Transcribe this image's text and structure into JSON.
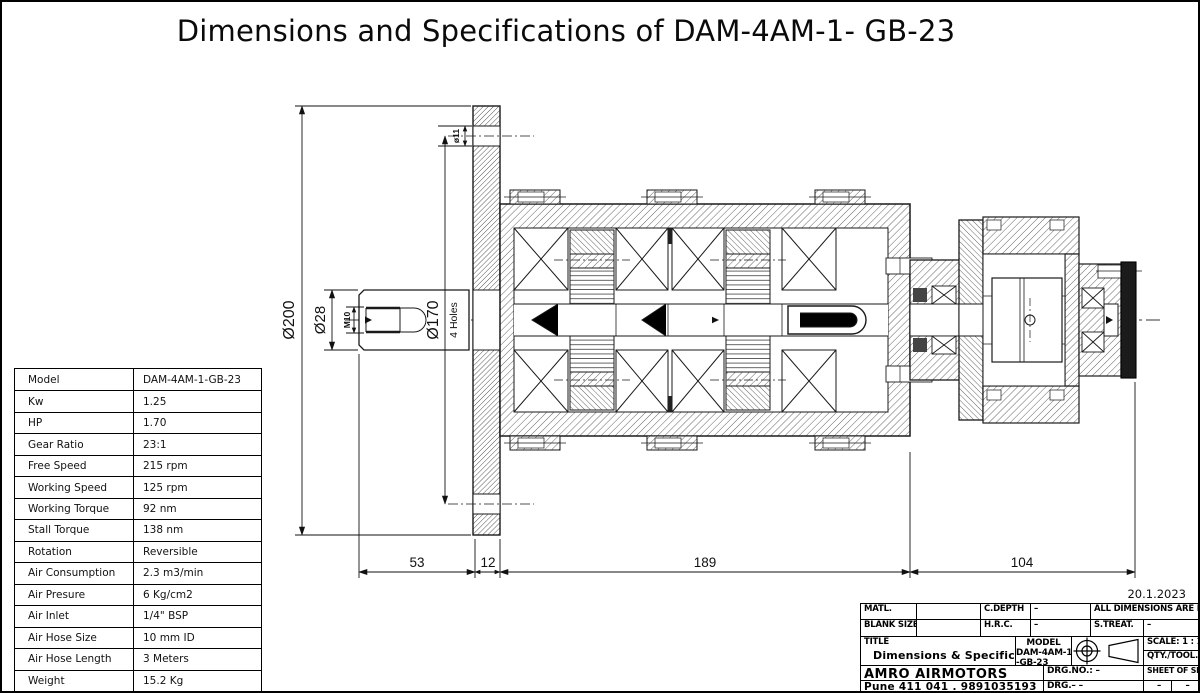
{
  "page": {
    "title": "Dimensions and Specifications of DAM-4AM-1- GB-23"
  },
  "spec_table": {
    "rows": [
      {
        "label": "Model",
        "value": "DAM-4AM-1-GB-23"
      },
      {
        "label": "Kw",
        "value": "1.25"
      },
      {
        "label": "HP",
        "value": "1.70"
      },
      {
        "label": "Gear Ratio",
        "value": "23:1"
      },
      {
        "label": "Free Speed",
        "value": "215 rpm"
      },
      {
        "label": "Working Speed",
        "value": "125 rpm"
      },
      {
        "label": "Working Torque",
        "value": "92 nm"
      },
      {
        "label": "Stall Torque",
        "value": "138 nm"
      },
      {
        "label": "Rotation",
        "value": "Reversible"
      },
      {
        "label": "Air Consumption",
        "value": "2.3 m3/min"
      },
      {
        "label": "Air Presure",
        "value": "6 Kg/cm2"
      },
      {
        "label": "Air Inlet",
        "value": "1/4\" BSP"
      },
      {
        "label": "Air Hose Size",
        "value": "10 mm ID"
      },
      {
        "label": "Air Hose Length",
        "value": "3 Meters"
      },
      {
        "label": "Weight",
        "value": "15.2 Kg"
      }
    ]
  },
  "drawing": {
    "dims": {
      "d200": "Ø200",
      "d28": "Ø28",
      "d170": "Ø170",
      "holes": "4 Holes",
      "m10": "M10",
      "d11": "ø11",
      "len_shaft": "53",
      "len_flange": "12",
      "len_gearbox": "189",
      "len_motor": "104"
    }
  },
  "title_block": {
    "date": "20.1.2023",
    "matl_label": "MATL.",
    "blank_size_label": "BLANK SIZE",
    "cdepth_label": "C.DEPTH",
    "cdepth_value": "–",
    "hrc_label": "H.R.C.",
    "hrc_value": "–",
    "all_dims_note": "ALL DIMENSIONS ARE IN MM.",
    "streat_label": "S.TREAT.",
    "streat_value": "–",
    "title_label": "TITLE",
    "title_value": "Dimensions & Specifications",
    "model_label": "MODEL",
    "model_value_line1": "DAM-4AM-1",
    "model_value_line2": "-GB-23",
    "scale": "SCALE: 1 : 1",
    "qty_tool": "QTY./TOOL.: –",
    "company": "AMRO AIRMOTORS",
    "address": "Pune 411 041 . 9891035193",
    "drg_no": "DRG.NO.: –",
    "drg": "DRG.– –",
    "sheet": "SHEET OF SHEETS",
    "dash1": "–",
    "dash2": "–"
  }
}
